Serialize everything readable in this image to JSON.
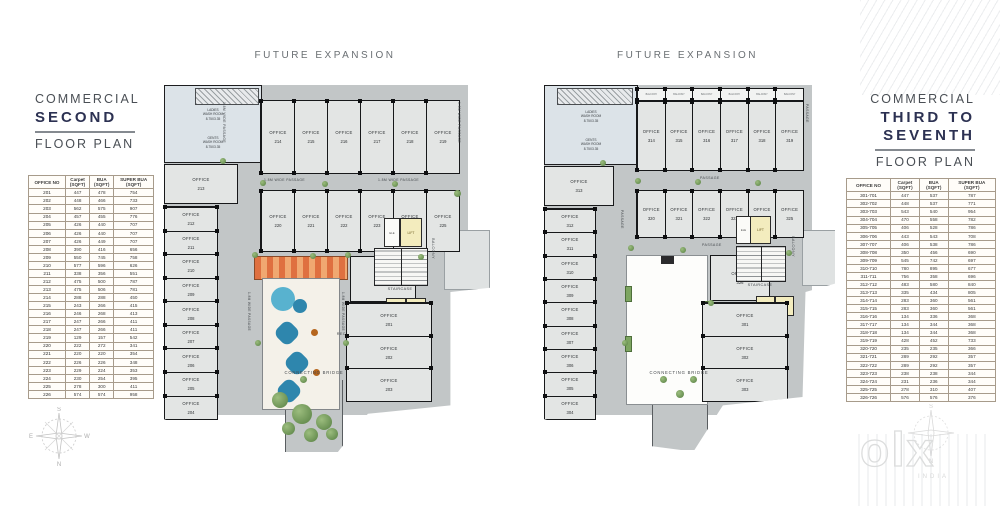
{
  "colors": {
    "slab": "#c2c6c7",
    "room": "#e3e5e4",
    "wall": "#17181a",
    "lift_yellow": "#f3ecbe",
    "canopy_orange": "#df7040",
    "water_blue": "#2e86ad",
    "plant_green": "#6f9d53",
    "title_navy": "#2c3152",
    "table_header_orange": "#b5812f"
  },
  "strings": {
    "office": "OFFICE"
  },
  "left_panel": {
    "title_line1": "COMMERCIAL",
    "title_line2": "SECOND",
    "title_line3": "FLOOR PLAN",
    "table": {
      "headers": [
        {
          "l1": "OFFICE NO",
          "l2": ""
        },
        {
          "l1": "Carpet",
          "l2": "(SQFT)"
        },
        {
          "l1": "BUA",
          "l2": "(SQFT)"
        },
        {
          "l1": "SUPER BUA",
          "l2": "(SQFT)"
        }
      ],
      "rows": [
        [
          "201",
          "447",
          "478",
          "754"
        ],
        [
          "202",
          "448",
          "466",
          "733"
        ],
        [
          "203",
          "562",
          "575",
          "907"
        ],
        [
          "204",
          "457",
          "455",
          "776"
        ],
        [
          "205",
          "426",
          "440",
          "707"
        ],
        [
          "206",
          "426",
          "440",
          "707"
        ],
        [
          "207",
          "426",
          "449",
          "707"
        ],
        [
          "208",
          "390",
          "416",
          "656"
        ],
        [
          "209",
          "550",
          "745",
          "758"
        ],
        [
          "210",
          "577",
          "596",
          "626"
        ],
        [
          "211",
          "338",
          "356",
          "551"
        ],
        [
          "212",
          "475",
          "500",
          "787"
        ],
        [
          "213",
          "475",
          "506",
          "781"
        ],
        [
          "214",
          "288",
          "288",
          "450"
        ],
        [
          "215",
          "243",
          "266",
          "415"
        ],
        [
          "216",
          "246",
          "268",
          "413"
        ],
        [
          "217",
          "247",
          "266",
          "411"
        ],
        [
          "218",
          "247",
          "266",
          "411"
        ],
        [
          "219",
          "129",
          "157",
          "542"
        ],
        [
          "220",
          "222",
          "272",
          "341"
        ],
        [
          "221",
          "220",
          "220",
          "354"
        ],
        [
          "222",
          "226",
          "226",
          "348"
        ],
        [
          "223",
          "229",
          "224",
          "353"
        ],
        [
          "224",
          "230",
          "254",
          "395"
        ],
        [
          "225",
          "278",
          "300",
          "411"
        ],
        [
          "226",
          "574",
          "574",
          "958"
        ]
      ]
    }
  },
  "right_panel": {
    "title_line1": "COMMERCIAL",
    "title_line2a": "THIRD TO",
    "title_line2b": "SEVENTH",
    "title_line3": "FLOOR PLAN",
    "table": {
      "headers": [
        {
          "l1": "OFFICE NO",
          "l2": ""
        },
        {
          "l1": "Carpet",
          "l2": "(SQFT)"
        },
        {
          "l1": "BUA",
          "l2": "(SQFT)"
        },
        {
          "l1": "SUPER BUA",
          "l2": "(SQFT)"
        }
      ],
      "rows": [
        [
          "301-701",
          "447",
          "537",
          "787"
        ],
        [
          "302-702",
          "448",
          "537",
          "771"
        ],
        [
          "303-703",
          "543",
          "540",
          "954"
        ],
        [
          "304-704",
          "470",
          "558",
          "782"
        ],
        [
          "305-705",
          "406",
          "528",
          "786"
        ],
        [
          "306-706",
          "443",
          "543",
          "708"
        ],
        [
          "307-707",
          "406",
          "538",
          "786"
        ],
        [
          "308-708",
          "350",
          "456",
          "690"
        ],
        [
          "309-709",
          "545",
          "742",
          "697"
        ],
        [
          "310-710",
          "780",
          "895",
          "677"
        ],
        [
          "311-711",
          "756",
          "358",
          "696"
        ],
        [
          "312-712",
          "483",
          "580",
          "840"
        ],
        [
          "313-713",
          "335",
          "434",
          "805"
        ],
        [
          "314-714",
          "283",
          "360",
          "561"
        ],
        [
          "315-715",
          "283",
          "360",
          "561"
        ],
        [
          "316-716",
          "134",
          "336",
          "368"
        ],
        [
          "317-717",
          "134",
          "344",
          "368"
        ],
        [
          "318-718",
          "134",
          "344",
          "368"
        ],
        [
          "319-719",
          "428",
          "452",
          "733"
        ],
        [
          "320-720",
          "235",
          "235",
          "366"
        ],
        [
          "321-721",
          "289",
          "292",
          "357"
        ],
        [
          "322-722",
          "289",
          "292",
          "357"
        ],
        [
          "323-723",
          "238",
          "238",
          "344"
        ],
        [
          "324-724",
          "231",
          "236",
          "344"
        ],
        [
          "325-725",
          "278",
          "310",
          "407"
        ],
        [
          "326-726",
          "576",
          "576",
          "376"
        ]
      ]
    }
  },
  "left_plan": {
    "future_expansion": "FUTURE EXPANSION",
    "office_213": "213",
    "left_col": [
      "212",
      "211",
      "210",
      "209",
      "208",
      "207",
      "206",
      "205",
      "204"
    ],
    "top_row": [
      "214",
      "215",
      "216",
      "217",
      "218",
      "219"
    ],
    "second_row": [
      "220",
      "221",
      "222",
      "223",
      "224",
      "225"
    ],
    "right_office": "226",
    "right_col": [
      "201",
      "202",
      "203"
    ],
    "labels": {
      "passage_a": "1.8M WIDE PASSAGE",
      "passage_b": "1.8M WIDE PASSAGE",
      "passage_left_vert": "1.8M WIDE PASSAGE",
      "passage_right_vert": "1.8M WIDE PASSAGE",
      "court_left_vert": "1.8M WIDE PASSAGE",
      "court_right_vert": "1.8M WIDE PASSAGE",
      "reception_l1": "PASSAGE,",
      "reception_l2": "RECEPTION AND WAITING",
      "staircase": "STAIRCASE",
      "lift": "LIFT",
      "ele": "ELE",
      "balcony": "BALCONY",
      "bridge": "CONNECTING BRIDGE",
      "ladies_l1": "LADIES",
      "ladies_l2": "WASH ROOM",
      "ladies_l3": "8.75X3.35",
      "gents_l1": "GENTS",
      "gents_l2": "WASH ROOM",
      "gents_l3": "8.75X3.35"
    }
  },
  "right_plan": {
    "future_expansion": "FUTURE EXPANSION",
    "office_313": "313",
    "left_col": [
      "312",
      "311",
      "310",
      "309",
      "308",
      "307",
      "306",
      "305",
      "304"
    ],
    "top_balconies": [
      "BALCONY",
      "BALCONY",
      "BALCONY",
      "BALCONY",
      "BALCONY",
      "BALCONY"
    ],
    "top_row": [
      "314",
      "315",
      "316",
      "317",
      "318",
      "319"
    ],
    "second_row": [
      "320",
      "321",
      "322",
      "323",
      "324",
      "325"
    ],
    "right_office": "326",
    "right_col": [
      "301",
      "302",
      "303"
    ],
    "labels": {
      "passage_top": "PASSAGE",
      "passage_mid": "PASSAGE",
      "passage_left_vert": "PASSAGE",
      "passage_right_vert": "PASSAGE",
      "passage_bridge_vert": "PASSAGE",
      "reception_l1": "PASSAGE,",
      "reception_l2": "RECEPTION AND WAITING",
      "staircase": "STAIRCASE",
      "lift": "LIFT",
      "ele": "ELE",
      "balcony": "BALCONY",
      "bridge": "CONNECTING BRIDGE",
      "ladies_l1": "LADIES",
      "ladies_l2": "WASH ROOM",
      "ladies_l3": "8.75X3.35",
      "gents_l1": "GENTS",
      "gents_l2": "WASH ROOM",
      "gents_l3": "8.75X3.35"
    }
  },
  "compass": {
    "n": "N",
    "s": "S",
    "e": "E",
    "w": "W"
  },
  "watermark": {
    "brand": "olx",
    "country": "INDIA"
  }
}
